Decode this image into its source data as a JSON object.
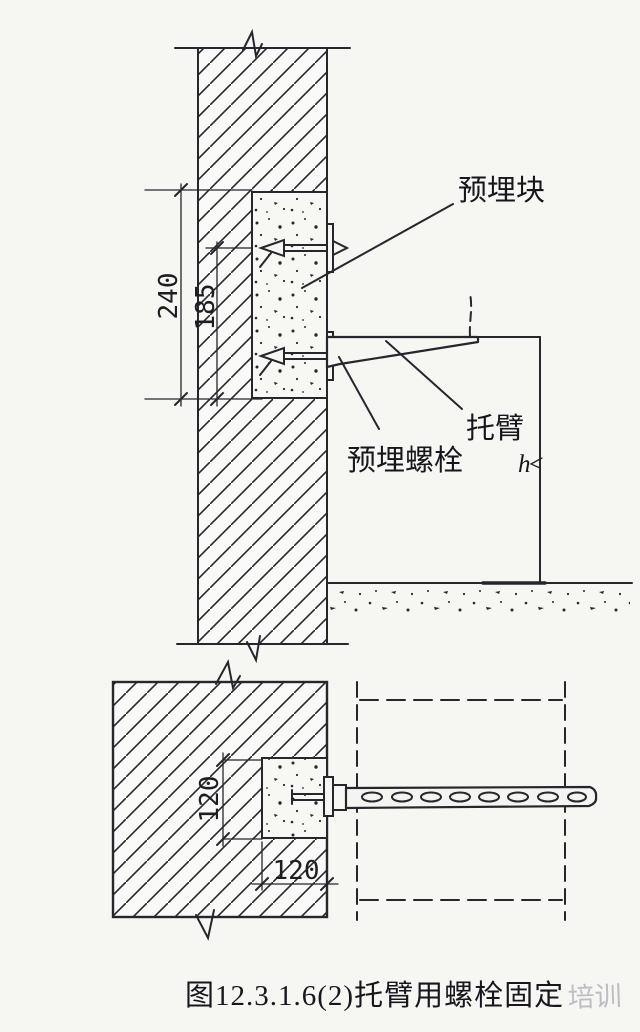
{
  "drawing": {
    "title_caption": "图12.3.1.6(2)托臂用螺栓固定",
    "watermark": "培训",
    "labels": {
      "embedded_block": "预埋块",
      "bracket": "托臂",
      "embedded_bolt": "预埋螺栓",
      "height_symbol": "h"
    },
    "dimensions": {
      "section_block_height": "240",
      "section_bolt_spacing": "185",
      "plan_block_depth": "120",
      "plan_block_width": "120"
    },
    "colors": {
      "line": "#26262c",
      "paper": "#f6f6f3",
      "watermark": "#b4b4bd"
    }
  }
}
